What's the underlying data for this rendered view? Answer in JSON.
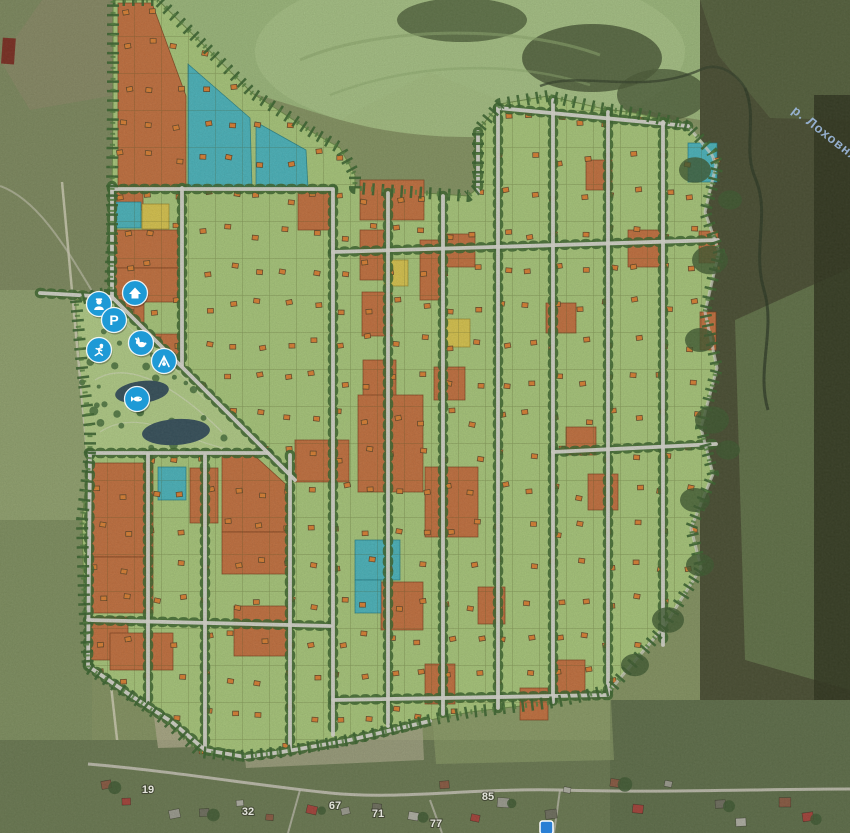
{
  "map": {
    "river_label": "р. Лоховня",
    "village_house_numbers": [
      {
        "label": "19",
        "x": 148,
        "y": 793
      },
      {
        "label": "32",
        "x": 248,
        "y": 815
      },
      {
        "label": "67",
        "x": 335,
        "y": 809
      },
      {
        "label": "71",
        "x": 378,
        "y": 817
      },
      {
        "label": "77",
        "x": 436,
        "y": 827
      },
      {
        "label": "85",
        "x": 488,
        "y": 800
      }
    ],
    "legend": {
      "available_plot_color": "#a9c87b",
      "orange_plot_color": "#c4713f",
      "teal_plot_color": "#4bb5bd",
      "yellow_plot_color": "#d9c54e",
      "road_color": "#dad9d1",
      "water_color": "#36505b",
      "marker_color": "#1e9ad6"
    },
    "amenities": [
      {
        "id": "office",
        "name": "office-house-icon",
        "x": 135,
        "y": 293
      },
      {
        "id": "security",
        "name": "security-guard-icon",
        "x": 99,
        "y": 304
      },
      {
        "id": "parking",
        "name": "parking-icon",
        "x": 114,
        "y": 320
      },
      {
        "id": "sports",
        "name": "sports-icon",
        "x": 99,
        "y": 350
      },
      {
        "id": "petting-zoo",
        "name": "rabbit-icon",
        "x": 141,
        "y": 343
      },
      {
        "id": "playground",
        "name": "playground-icon",
        "x": 164,
        "y": 361
      },
      {
        "id": "fishing",
        "name": "fish-icon",
        "x": 137,
        "y": 399
      }
    ],
    "parking_letter": "P",
    "plots": {
      "orange_rects": [
        [
          115,
          186,
          28,
          24
        ],
        [
          112,
          230,
          66,
          38
        ],
        [
          112,
          268,
          66,
          34
        ],
        [
          112,
          302,
          32,
          62
        ],
        [
          144,
          334,
          36,
          30
        ],
        [
          298,
          192,
          32,
          38
        ],
        [
          360,
          180,
          64,
          40
        ],
        [
          360,
          230,
          24,
          50
        ],
        [
          445,
          234,
          30,
          33
        ],
        [
          420,
          240,
          23,
          60
        ],
        [
          362,
          292,
          30,
          44
        ],
        [
          363,
          360,
          33,
          37
        ],
        [
          358,
          395,
          65,
          97
        ],
        [
          586,
          160,
          26,
          30
        ],
        [
          628,
          230,
          34,
          37
        ],
        [
          699,
          231,
          19,
          32
        ],
        [
          700,
          312,
          16,
          38
        ],
        [
          546,
          303,
          30,
          30
        ],
        [
          434,
          367,
          31,
          33
        ],
        [
          566,
          427,
          30,
          28
        ],
        [
          588,
          474,
          30,
          36
        ],
        [
          425,
          467,
          53,
          70
        ],
        [
          478,
          587,
          27,
          37
        ],
        [
          520,
          688,
          28,
          32
        ],
        [
          425,
          664,
          30,
          40
        ],
        [
          556,
          660,
          29,
          37
        ],
        [
          92,
          463,
          61,
          94
        ],
        [
          92,
          557,
          61,
          56
        ],
        [
          190,
          468,
          28,
          55
        ],
        [
          295,
          440,
          54,
          42
        ],
        [
          222,
          532,
          68,
          42
        ],
        [
          234,
          606,
          56,
          50
        ],
        [
          88,
          617,
          40,
          43
        ],
        [
          110,
          633,
          63,
          37
        ],
        [
          381,
          582,
          42,
          48
        ]
      ],
      "teal_rects": [
        [
          116,
          202,
          25,
          26
        ],
        [
          158,
          467,
          28,
          33
        ],
        [
          355,
          540,
          45,
          40
        ],
        [
          355,
          580,
          26,
          33
        ],
        [
          688,
          143,
          29,
          39
        ]
      ],
      "yellow_rects": [
        [
          142,
          204,
          27,
          25
        ],
        [
          444,
          319,
          26,
          28
        ],
        [
          384,
          260,
          24,
          26
        ]
      ],
      "orange_polygons": [
        "118,3 152,3 186,96 186,188 118,188",
        "222,426 290,488 290,532 222,532"
      ],
      "teal_polygons": [
        "188,64 250,118 252,188 188,188",
        "256,122 306,150 308,188 256,188"
      ]
    }
  }
}
